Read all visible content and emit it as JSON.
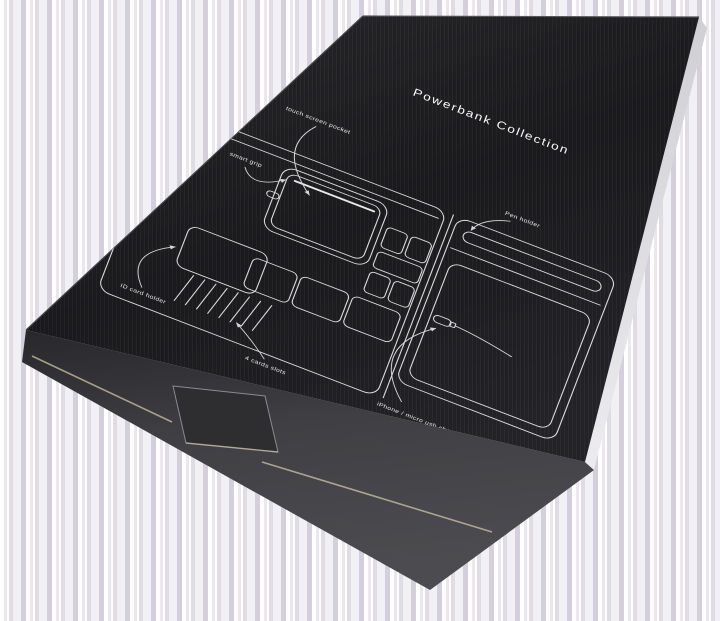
{
  "photo": {
    "description": "Black cardboard product box photographed at an angle on a light striped background, printed with a white line blueprint of a powerbank organizer folio",
    "background": {
      "stripe_colors": [
        "#ffffff",
        "#dad6e0",
        "#efedf3",
        "#ccc8d5"
      ]
    },
    "box": {
      "title": "Powerbank Collection",
      "face_color": "#1b1b1e",
      "side_color": "#3f3f44",
      "paper_edge_color": "#e4e4e8",
      "cardboard_edge_color": "#cec4ab",
      "line_color": "#dcdcdc"
    },
    "diagram": {
      "labels": {
        "touch_screen_pocket": "touch screen pocket",
        "smart_grip": "smart grip",
        "pen_holder": "Pen holder",
        "id_card_holder": "ID card holder",
        "four_cards_slots": "4 cards slots",
        "iphone_charging": "iPhone / micro usb charging"
      }
    }
  }
}
